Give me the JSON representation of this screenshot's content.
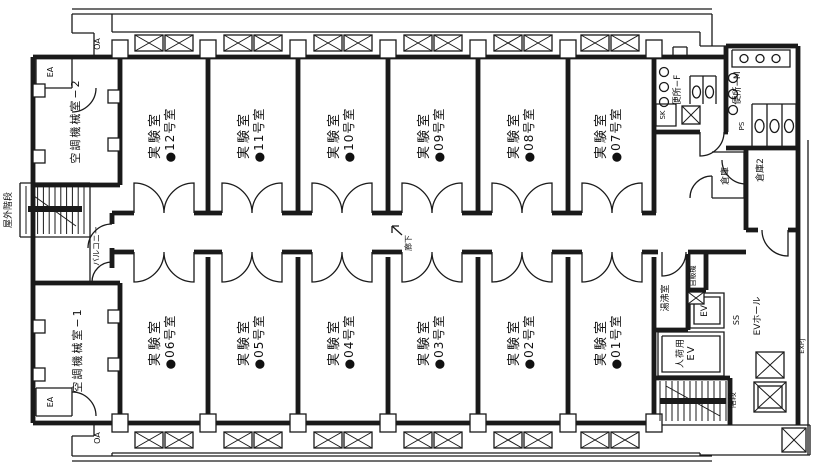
{
  "plan": {
    "rooms_upper": [
      {
        "name": "実験室",
        "num": "●12号室"
      },
      {
        "name": "実験室",
        "num": "●11号室"
      },
      {
        "name": "実験室",
        "num": "●10号室"
      },
      {
        "name": "実験室",
        "num": "●09号室"
      },
      {
        "name": "実験室",
        "num": "●08号室"
      },
      {
        "name": "実験室",
        "num": "●07号室"
      }
    ],
    "rooms_lower": [
      {
        "name": "実験室",
        "num": "●06号室"
      },
      {
        "name": "実験室",
        "num": "●05号室"
      },
      {
        "name": "実験室",
        "num": "●04号室"
      },
      {
        "name": "実験室",
        "num": "●03号室"
      },
      {
        "name": "実験室",
        "num": "●02号室"
      },
      {
        "name": "実験室",
        "num": "●01号室"
      }
    ],
    "labels": {
      "mech_room_2": "空調機械室−2",
      "mech_room_1": "空調機械室−1",
      "outdoor_stairs": "屋外階段",
      "balcony": "バルコニー",
      "corridor": "廊下",
      "toilet_f": "便所−F",
      "toilet_m": "便所−M",
      "sink_sk": "SK",
      "pipe_space_ps": "PS",
      "storage": "倉庫",
      "storage_2": "倉庫2",
      "hot_water_room": "湯沸室",
      "vending_machine": "自販機",
      "elevator": "EV",
      "freight_elevator_l1": "人荷用",
      "freight_elevator_l2": "EV",
      "ss": "SS",
      "elevator_hall": "EVホール",
      "staircase": "階段",
      "expansion_joint": "EXP.J",
      "exhaust_air": "EA",
      "outside_air": "OA"
    },
    "colors": {
      "line": "#1a1a1a",
      "background": "#ffffff"
    }
  }
}
